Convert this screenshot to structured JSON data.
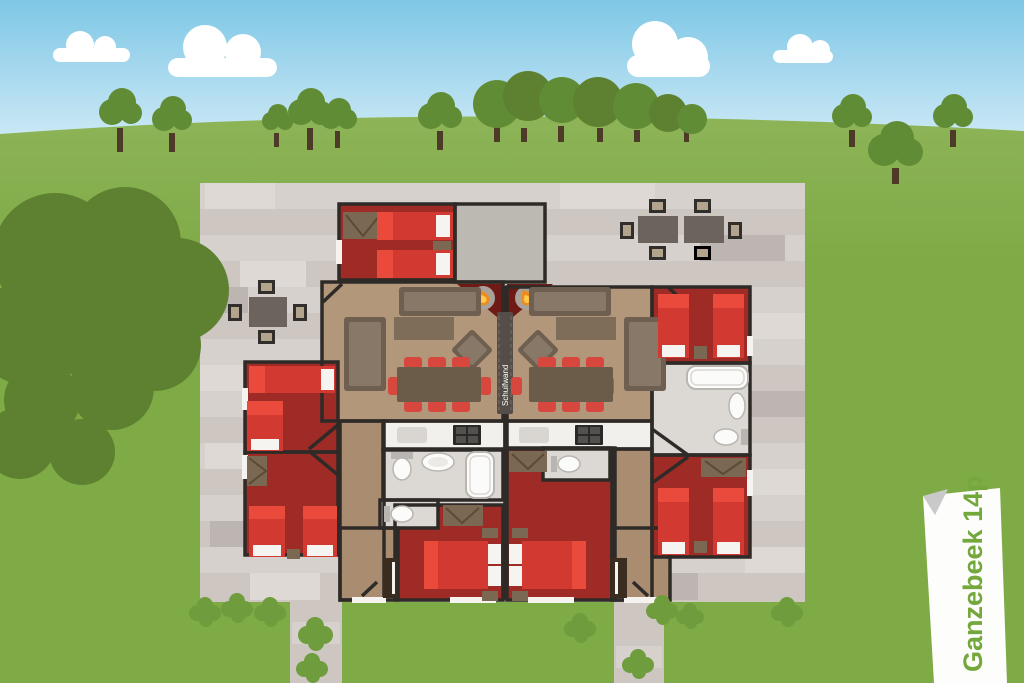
{
  "ribbon": {
    "label": "Ganzebeek 14p"
  },
  "floorplan": {
    "sliding_wall_label": "Schuifwand"
  },
  "colors": {
    "sky-top": "#7ec7e6",
    "sky-bottom": "#d8eef8",
    "cloud": "#ffffff",
    "grass": "#7fab47",
    "grass-light": "#8db457",
    "tree-dark": "#5d8130",
    "tree-mid": "#618c36",
    "tree-trunk": "#4e3a28",
    "bush": "#6f9d3d",
    "paving": "#cdc6c1",
    "paving-light": "#d7d1cd",
    "paving-lighter": "#ded9d5",
    "paving-dark": "#bcb5b1",
    "wall": "#2e2a27",
    "bedroom-floor": "#9e2b26",
    "bed-red": "#d23a31",
    "bed-bright": "#ea4a3c",
    "pillow": "#f6f4f1",
    "living-floor": "#b3977b",
    "hall-floor": "#aa8d70",
    "furniture": "#6e5f50",
    "furniture-light": "#877868",
    "table-brown": "#6b5b49",
    "coffee-table": "#7e6d58",
    "wardrobe": "#7b6852",
    "wardrobe-line": "#5a4a36",
    "chair-red": "#d8473e",
    "counter-white": "#f2f0ed",
    "sink-gray": "#d9d6d2",
    "hob-black": "#2b2927",
    "hob-burner": "#54504d",
    "bath-floor": "#dcd8d4",
    "fixture-white": "#fbfbfa",
    "fixture-line": "#b9b5b1",
    "storage-floor": "#bcb8b2",
    "fireplace-red": "#6e1a17",
    "fireplace-gray": "#a8a29b",
    "flame-orange": "#f08c1c",
    "flame-yellow": "#ffc94e",
    "divider": "#554e48",
    "door-dark": "#3a2d20",
    "outdoor-table": "#6c635c",
    "outdoor-chair": "#322e2b",
    "outdoor-seat": "#b3a58d",
    "ribbon-white": "#fdfdfc",
    "ribbon-fold": "#c9c9c9",
    "ribbon-green": "#74a73c",
    "opening-white": "#f5f3f0"
  }
}
